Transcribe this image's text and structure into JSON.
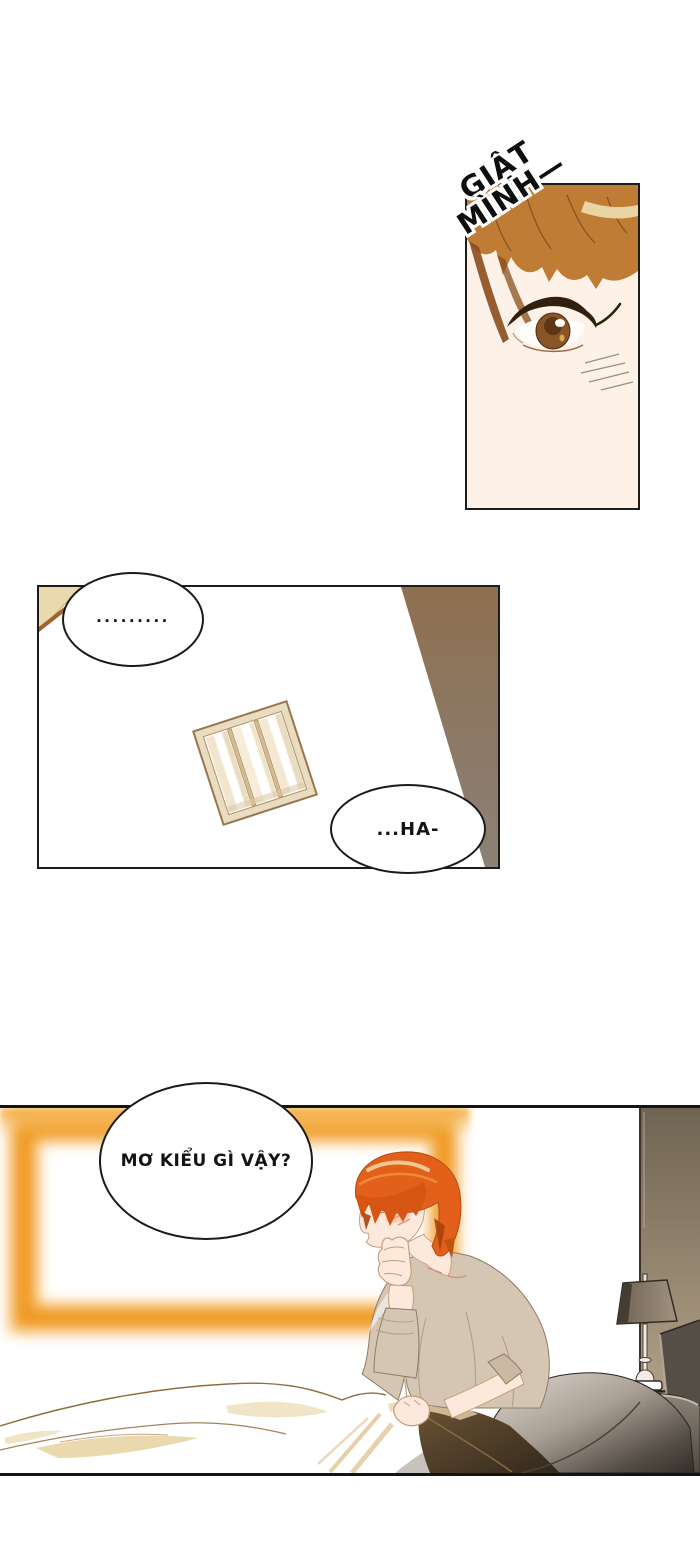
{
  "sfx": {
    "line1": "GIẬT",
    "line2": "MÌNH—"
  },
  "bubbles": {
    "silence": ".........",
    "ha": "...HA-",
    "dream": "MƠ KIỂU GÌ VẬY?"
  },
  "colors": {
    "panel_border": "#1c1c1c",
    "hair_brown_panel1": "#bf7c34",
    "hair_highlight_cream": "#ecd9ab",
    "eye_iris_brown": "#8a5526",
    "skin_light": "#fdf1e8",
    "hair_orange": "#e2601a",
    "shirt_beige": "#d5c6b3",
    "window_glow_orange": "#ee9513",
    "wall_taupe_top": "#6f6452",
    "wall_taupe_bottom": "#b3a188",
    "pillow_dark": "#38332e",
    "wedge_brown": "#8e6f50",
    "wedge_gray": "#8b8177",
    "curtain_frame_cream": "#eadcc0"
  }
}
